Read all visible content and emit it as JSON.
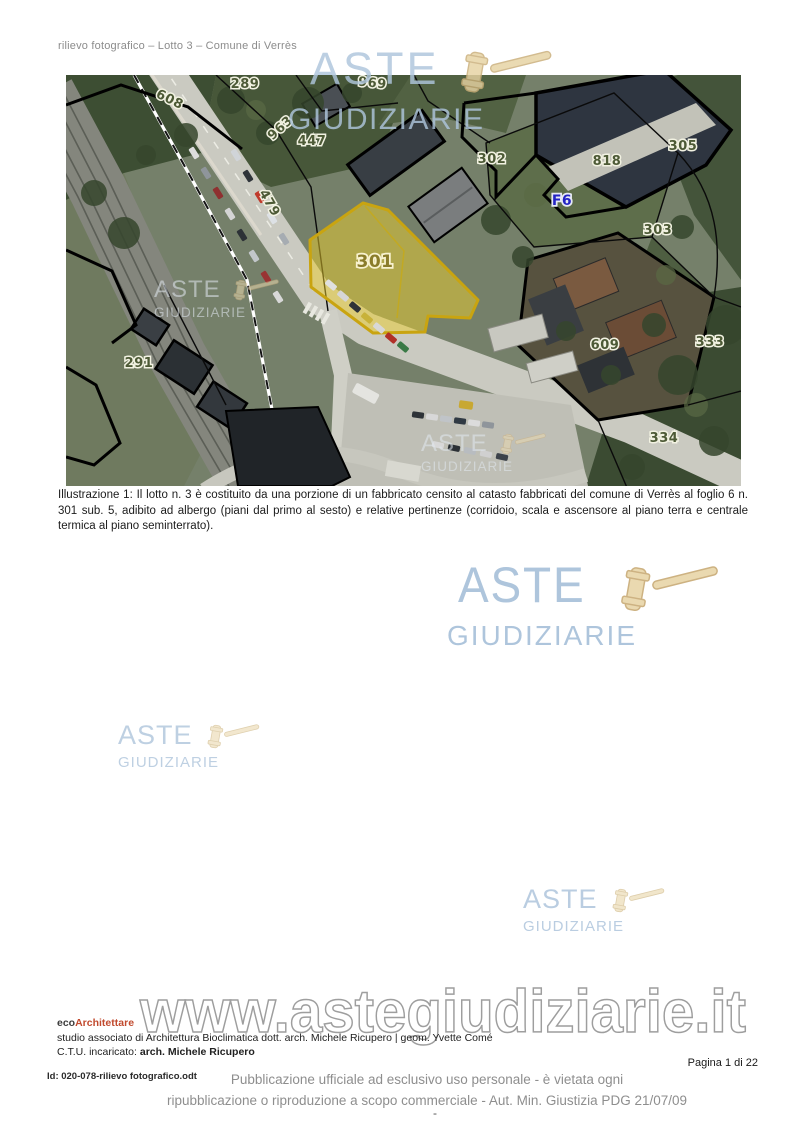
{
  "page": {
    "header": "rilievo fotografico – Lotto 3 – Comune di Verrès",
    "caption": "Illustrazione 1:  Il lotto n. 3 è costituito da una porzione di un fabbricato censito al catasto fabbricati del comune di Verrès al foglio 6 n. 301 sub. 5, adibito ad albergo (piani dal primo al sesto) e relative pertinenze (corridoio, scala e ascensore al piano terra e centrale termica al piano seminterrato).",
    "page_number": "Pagina 1 di 22",
    "doc_id": "Id: 020-078-rilievo fotografico.odt",
    "legal_line1": "Pubblicazione ufficiale ad esclusivo uso personale - è vietata ogni",
    "legal_line2": "ripubblicazione o riproduzione a scopo commerciale - Aut. Min. Giustizia PDG 21/07/09",
    "footer_dash": "-"
  },
  "firm": {
    "name_eco": "eco",
    "name_rest": "Architettare",
    "studio_line": "studio associato di Architettura Bioclimatica dott. arch. Michele Ricupero | geom. Yvette Comé",
    "ctu_label": "C.T.U. incaricato: ",
    "ctu_name": "arch. Michele Ricupero"
  },
  "watermark": {
    "line1": "ASTE",
    "line2": "GIUDIZIARIE",
    "url": "www.astegiudiziarie.it",
    "blue": "#aec5dc",
    "tan": "#ead9b0"
  },
  "map": {
    "description": "aerial cadastral view of Verrès, lot 3",
    "highlight_parcel": "301",
    "highlight_color": "#e8c832",
    "labels": [
      {
        "text": "608",
        "x": 102,
        "y": 28,
        "rot": 26
      },
      {
        "text": "289",
        "x": 179,
        "y": 13
      },
      {
        "text": "969",
        "x": 306,
        "y": 12,
        "rot": 6
      },
      {
        "text": "963",
        "x": 217,
        "y": 56,
        "rot": -42
      },
      {
        "text": "447",
        "x": 246,
        "y": 70
      },
      {
        "text": "479",
        "x": 200,
        "y": 130,
        "rot": 60
      },
      {
        "text": "302",
        "x": 426,
        "y": 88
      },
      {
        "text": "818",
        "x": 541,
        "y": 90
      },
      {
        "text": "305",
        "x": 617,
        "y": 75
      },
      {
        "text": "303",
        "x": 592,
        "y": 159
      },
      {
        "text": "F6",
        "x": 496,
        "y": 130,
        "kind": "zone"
      },
      {
        "text": "301",
        "x": 309,
        "y": 192,
        "kind": "hl"
      },
      {
        "text": "291",
        "x": 73,
        "y": 292
      },
      {
        "text": "609",
        "x": 539,
        "y": 274
      },
      {
        "text": "333",
        "x": 644,
        "y": 271
      },
      {
        "text": "334",
        "x": 598,
        "y": 367
      }
    ]
  }
}
